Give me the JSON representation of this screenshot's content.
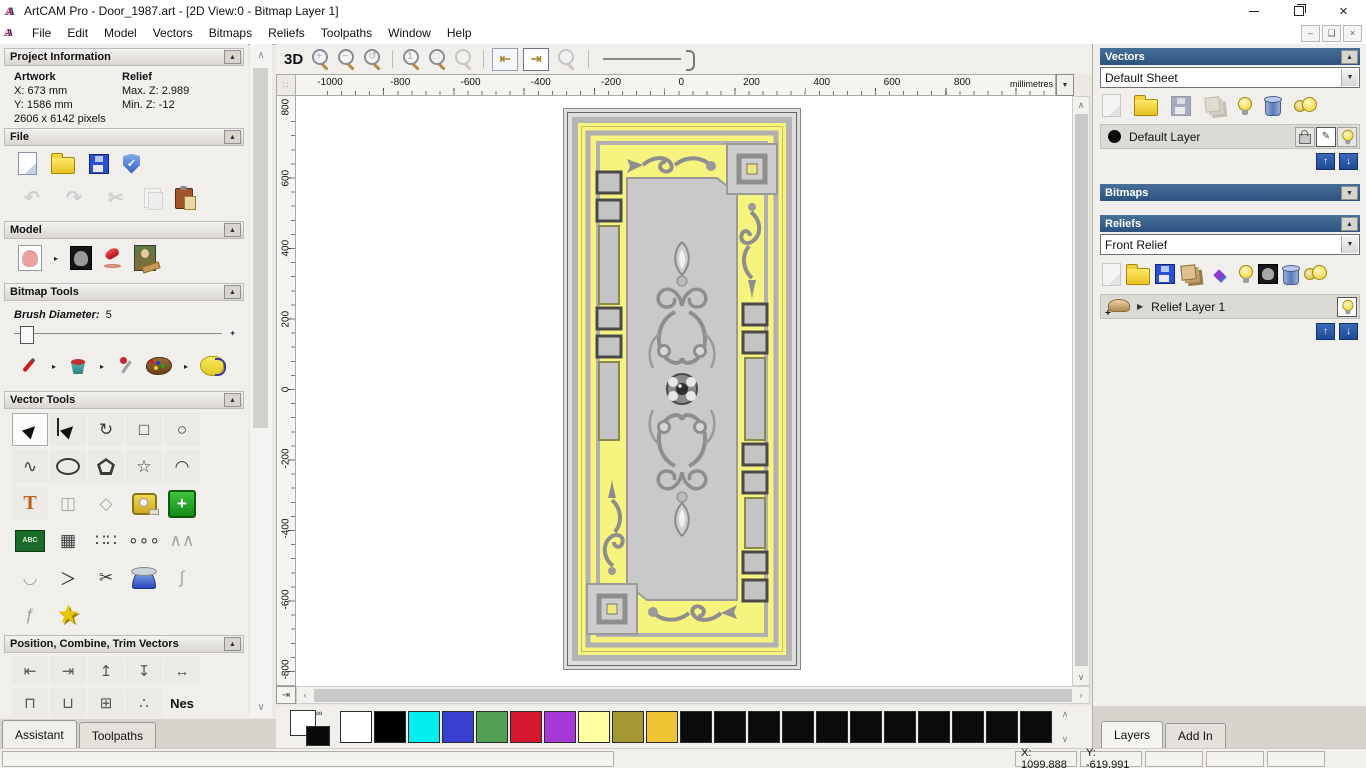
{
  "window": {
    "title": "ArtCAM Pro - Door_1987.art - [2D View:0 - Bitmap Layer 1]",
    "app_icon": "artcam-logo"
  },
  "menu": {
    "items": [
      "File",
      "Edit",
      "Model",
      "Vectors",
      "Bitmaps",
      "Reliefs",
      "Toolpaths",
      "Window",
      "Help"
    ]
  },
  "assistant": {
    "project_info": {
      "title": "Project Information",
      "artwork_label": "Artwork",
      "artwork_x": "X: 673 mm",
      "artwork_y": "Y: 1586 mm",
      "artwork_pixels": "2606 x 6142 pixels",
      "relief_label": "Relief",
      "relief_max": "Max. Z: 2.989",
      "relief_min": "Min. Z: -12"
    },
    "file_section": {
      "title": "File",
      "icons_row1": [
        {
          "n": "new-model-icon",
          "cls": "ic-page"
        },
        {
          "n": "open-model-icon",
          "cls": "ic-folder"
        },
        {
          "n": "save-model-icon",
          "cls": "ic-floppy"
        },
        {
          "n": "preferences-shield-icon",
          "cls": "ic-shield",
          "g": "✓"
        }
      ],
      "icons_row2": [
        {
          "n": "undo-icon",
          "cls": "ic-glyph18 dim",
          "g": "↶"
        },
        {
          "n": "redo-icon",
          "cls": "ic-glyph18 dim",
          "g": "↷"
        },
        {
          "n": "cut-icon",
          "cls": "ic-glyph18 dim",
          "g": "✂"
        },
        {
          "n": "copy-icon",
          "cls": "ic-copy dim"
        },
        {
          "n": "paste-icon",
          "cls": "ic-paste"
        }
      ]
    },
    "model_section": {
      "title": "Model",
      "icons": [
        {
          "n": "set-model-size-icon",
          "cls": "ic-sketch"
        },
        {
          "n": "flyout-arrow-icon",
          "cls": "ic-fly",
          "g": "▸"
        },
        {
          "n": "invert-model-icon",
          "cls": "ic-sketchdark"
        },
        {
          "n": "lighting-icon",
          "cls": "ic-lamp"
        },
        {
          "n": "load-texture-image-icon",
          "cls": "ic-mona"
        }
      ]
    },
    "bitmap_tools": {
      "title": "Bitmap Tools",
      "brush_diameter_label": "Brush Diameter:",
      "brush_diameter_value": "5",
      "icons": [
        {
          "n": "paint-brush-icon",
          "cls": "ic-brush"
        },
        {
          "n": "flyout-arrow-icon",
          "cls": "ic-fly",
          "g": "▸"
        },
        {
          "n": "flood-fill-icon",
          "cls": "ic-bucket"
        },
        {
          "n": "flyout-arrow-icon",
          "cls": "ic-fly",
          "g": "▸"
        },
        {
          "n": "colour-picker-icon",
          "cls": "ic-dropper"
        },
        {
          "n": "colour-palette-icon",
          "cls": "ic-palette"
        },
        {
          "n": "flyout-arrow-icon",
          "cls": "ic-fly",
          "g": "▸"
        },
        {
          "n": "reduce-colours-icon",
          "cls": "ic-blob"
        }
      ]
    },
    "vector_tools": {
      "title": "Vector Tools",
      "rows": [
        [
          {
            "n": "select-vectors-tool",
            "cls": "vsel",
            "g": "▶",
            "sel": true
          },
          {
            "n": "node-editing-tool",
            "g": "▶",
            "node": true
          },
          {
            "n": "transform-vectors-tool",
            "g": "↻"
          },
          {
            "n": "create-rectangle-tool",
            "g": "□"
          },
          {
            "n": "create-circle-tool",
            "g": "○"
          }
        ],
        [
          {
            "n": "create-freeform-shape-tool",
            "g": "∿"
          },
          {
            "n": "create-ellipse-tool",
            "cls": "oval"
          },
          {
            "n": "create-polygon-tool",
            "cls": "penta"
          },
          {
            "n": "create-star-tool",
            "g": "☆"
          },
          {
            "n": "create-arc-tool",
            "g": "◠"
          }
        ],
        [
          {
            "n": "create-text-tool",
            "cls": "ttool",
            "g": "T"
          },
          {
            "n": "wrap-text-tool",
            "cls": "flat dim",
            "g": "◫"
          },
          {
            "n": "offset-vectors-tool",
            "cls": "flat dim",
            "g": "◇"
          },
          {
            "n": "measure-tool",
            "cls": "flat meas"
          },
          {
            "n": "doctor-vectors-tool",
            "cls": "flat cross",
            "g": "+"
          }
        ],
        [
          {
            "n": "text-block-tool",
            "cls": "flat abc",
            "g": "ABC"
          },
          {
            "n": "distort-vectors-tool",
            "cls": "flat",
            "g": "▦"
          },
          {
            "n": "block-paste-tool",
            "cls": "flat",
            "g": "∷∷"
          },
          {
            "n": "paste-along-curve-tool",
            "cls": "flat",
            "g": "∘∘∘"
          },
          {
            "n": "vector-texture-tool",
            "cls": "flat dim",
            "g": "∧∧"
          }
        ],
        [
          {
            "n": "fit-arcs-tool",
            "cls": "flat dim",
            "g": "◡"
          },
          {
            "n": "join-vectors-tool",
            "cls": "flat",
            "g": "＞"
          },
          {
            "n": "trim-vectors-tool",
            "cls": "flat",
            "g": "✂"
          },
          {
            "n": "spin-relief-tool",
            "cls": "flat dometool"
          },
          {
            "n": "fit-curve-tool",
            "cls": "flat dim",
            "g": "∫"
          }
        ],
        [
          {
            "n": "mirror-vectors-tool",
            "cls": "flat dim",
            "g": "ƒ"
          },
          {
            "n": "star-wizard-tool",
            "cls": "flat goldstar",
            "g": "★"
          }
        ]
      ]
    },
    "position_section": {
      "title": "Position, Combine, Trim Vectors",
      "row1": [
        {
          "n": "align-left-icon",
          "g": "⇤"
        },
        {
          "n": "align-right-icon",
          "g": "⇥"
        },
        {
          "n": "align-top-icon",
          "g": "↥"
        },
        {
          "n": "align-bottom-icon",
          "g": "↧"
        },
        {
          "n": "align-centre-h-icon",
          "g": "↔"
        }
      ],
      "row2": [
        {
          "n": "align-centre-icon",
          "g": "⊓"
        },
        {
          "n": "align-centre-in-page-icon",
          "g": "⊔"
        },
        {
          "n": "paste-in-position-icon",
          "g": "⊞"
        },
        {
          "n": "scatter-copies-icon",
          "g": "∴"
        },
        {
          "n": "nesting-icon",
          "cls": "nes",
          "g": "Nes"
        }
      ]
    },
    "tabs": [
      {
        "label": "Assistant",
        "active": true
      },
      {
        "label": "Toolpaths",
        "active": false
      }
    ]
  },
  "canvas": {
    "toolbar": {
      "view3d_label": "3D",
      "icons": [
        {
          "n": "zoom-in-icon",
          "cls": "ic-zoom",
          "g": "+"
        },
        {
          "n": "zoom-out-icon",
          "cls": "ic-zoom",
          "g": "−"
        },
        {
          "n": "zoom-previous-icon",
          "cls": "ic-zoom",
          "g": "↺"
        }
      ],
      "icons2": [
        {
          "n": "zoom-1to1-icon",
          "cls": "ic-zoom",
          "g": "1"
        },
        {
          "n": "zoom-objects-icon",
          "cls": "ic-zoom",
          "g": "□"
        },
        {
          "n": "zoom-limits-icon",
          "cls": "ic-zoom dim"
        }
      ]
    },
    "ruler_h": [
      "-1000",
      "-800",
      "-600",
      "-400",
      "-200",
      "0",
      "200",
      "400",
      "600",
      "800"
    ],
    "ruler_unit": "millimetres",
    "ruler_v": [
      "800",
      "600",
      "400",
      "200",
      "0",
      "-200",
      "-400",
      "-600",
      "-800"
    ],
    "artwork_colors": {
      "panel_yellow": "#f7f37f",
      "metal_gray": "#b4b4b4",
      "inner_gray": "#c9c9c9"
    }
  },
  "right_panel": {
    "vectors": {
      "title": "Vectors",
      "sheet_value": "Default Sheet",
      "layer_name": "Default Layer",
      "icons": [
        {
          "n": "new-vector-layer-icon",
          "cls": "ic-page dim"
        },
        {
          "n": "open-vector-layer-icon",
          "cls": "ic-folder"
        },
        {
          "n": "save-vector-layer-icon",
          "cls": "ic-floppy dim"
        },
        {
          "n": "merge-vector-layers-icon",
          "cls": "ic-stack dim"
        },
        {
          "n": "toggle-layer-visibility-icon",
          "cls": "ic-bulb"
        },
        {
          "n": "delete-vector-layer-icon",
          "cls": "ic-trash"
        },
        {
          "n": "toggle-all-layers-icon",
          "cls": "ic-bulb2"
        }
      ]
    },
    "bitmaps": {
      "title": "Bitmaps"
    },
    "reliefs": {
      "title": "Reliefs",
      "relief_value": "Front Relief",
      "layer_name": "Relief Layer 1",
      "icons": [
        {
          "n": "new-relief-layer-icon",
          "cls": "ic-page dim"
        },
        {
          "n": "open-relief-layer-icon",
          "cls": "ic-folder"
        },
        {
          "n": "save-relief-layer-icon",
          "cls": "ic-floppy"
        },
        {
          "n": "merge-relief-layers-icon",
          "cls": "ic-stack"
        },
        {
          "n": "combine-relief-icon",
          "cls": "ic-diamond",
          "g": "◆"
        },
        {
          "n": "toggle-relief-visibility-icon",
          "cls": "ic-bulb"
        },
        {
          "n": "relief-preview-icon",
          "cls": "ic-teddy"
        },
        {
          "n": "delete-relief-layer-icon",
          "cls": "ic-trash"
        },
        {
          "n": "toggle-all-reliefs-icon",
          "cls": "ic-bulb2"
        }
      ]
    }
  },
  "palette": {
    "colors": [
      "#ffffff",
      "#000000",
      "#00eeee",
      "#3a3fd0",
      "#53a055",
      "#d6182e",
      "#a639d6",
      "#ffffa2",
      "#a59733",
      "#eec431",
      "#0b0b0b",
      "#0b0b0b",
      "#0b0b0b",
      "#0b0b0b",
      "#0b0b0b",
      "#0b0b0b",
      "#0b0b0b",
      "#0b0b0b",
      "#0b0b0b",
      "#0b0b0b",
      "#0b0b0b"
    ]
  },
  "bottom_tabs": [
    {
      "label": "Layers",
      "active": true
    },
    {
      "label": "Add In",
      "active": false
    }
  ],
  "status": {
    "x_readout": "X: 1099.888",
    "y_readout": "Y: -619.991"
  }
}
